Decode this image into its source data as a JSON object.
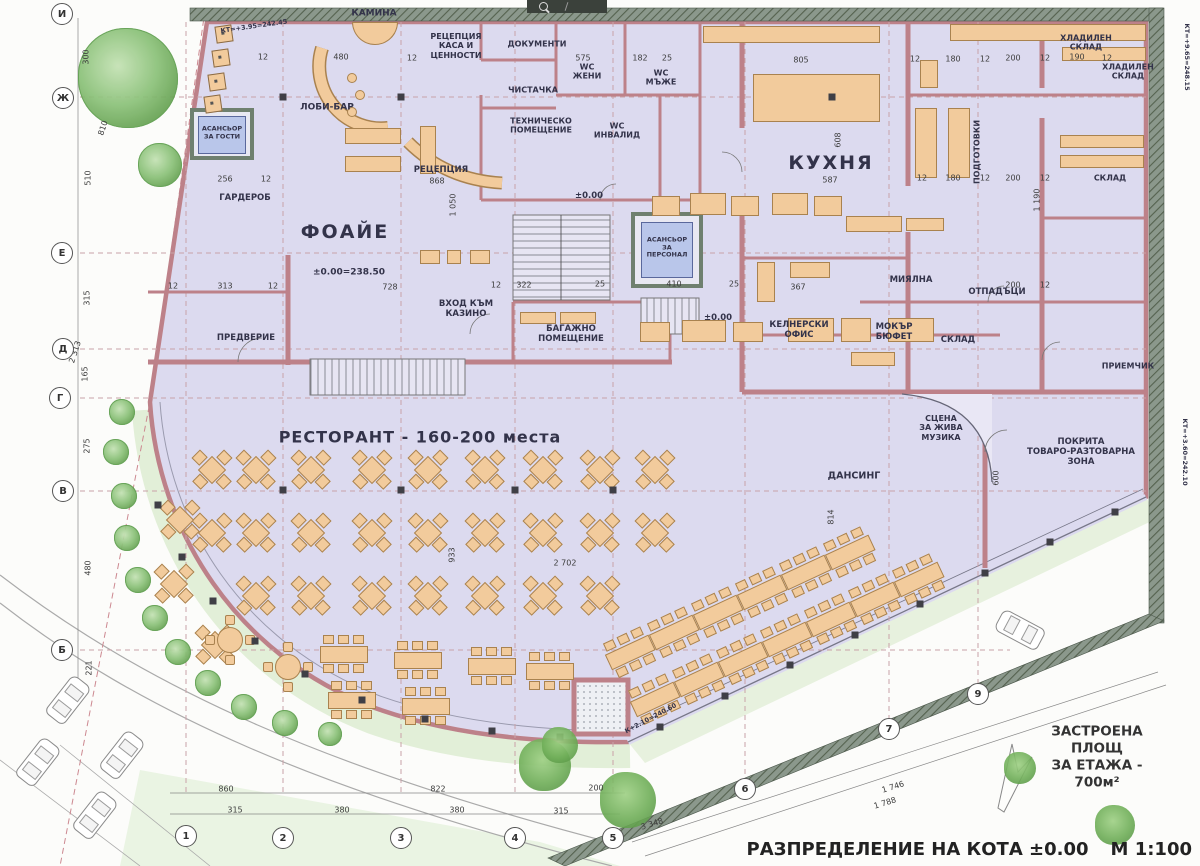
{
  "title_block": {
    "title": "РАЗПРЕДЕЛЕНИЕ НА КОТА ±0.00",
    "scale": "М 1:100",
    "area_note": "ЗАСТРОЕНА ПЛОЩ\nЗА ЕТАЖА - 700м²"
  },
  "labels": [
    {
      "n": "fireplace",
      "t": "КАМИНА",
      "x": 374,
      "y": 14,
      "fs": 9
    },
    {
      "n": "reception-cash",
      "t": "РЕЦЕПЦИЯ\nКАСА И\nЦЕННОСТИ",
      "x": 456,
      "y": 46,
      "fs": 8
    },
    {
      "n": "documents",
      "t": "ДОКУМЕНТИ",
      "x": 537,
      "y": 44,
      "fs": 8
    },
    {
      "n": "cleaner",
      "t": "ЧИСТАЧКА",
      "x": 533,
      "y": 90,
      "fs": 8
    },
    {
      "n": "tech-room",
      "t": "ТЕХНИЧЕСКО\nПОМЕЩЕНИЕ",
      "x": 541,
      "y": 126,
      "fs": 8
    },
    {
      "n": "lobby-bar",
      "t": "ЛОБИ-БАР",
      "x": 327,
      "y": 108,
      "fs": 9
    },
    {
      "n": "reception",
      "t": "РЕЦЕПЦИЯ",
      "x": 441,
      "y": 170,
      "fs": 8.5
    },
    {
      "n": "guest-elevator",
      "t": "АСАНСЬОР\nЗА ГОСТИ",
      "x": 222,
      "y": 133,
      "fs": 6.5
    },
    {
      "n": "wardrobe",
      "t": "ГАРДЕРОБ",
      "x": 245,
      "y": 198,
      "fs": 8.5
    },
    {
      "n": "foyer",
      "t": "ФОАЙЕ",
      "x": 345,
      "y": 232,
      "fs": 19,
      "ls": 2
    },
    {
      "n": "foyer-level",
      "t": "±0.00=238.50",
      "x": 349,
      "y": 273,
      "fs": 9
    },
    {
      "n": "vestibule",
      "t": "ПРЕДВЕРИЕ",
      "x": 246,
      "y": 338,
      "fs": 8.5
    },
    {
      "n": "casino-entrance",
      "t": "ВХОД КЪМ\nКАЗИНО",
      "x": 466,
      "y": 309,
      "fs": 8.5
    },
    {
      "n": "luggage-room",
      "t": "БАГАЖНО\nПОМЕЩЕНИЕ",
      "x": 571,
      "y": 334,
      "fs": 8.5
    },
    {
      "n": "staff-elevator",
      "t": "АСАНСЬОР\nЗА\nПЕРСОНАЛ",
      "x": 667,
      "y": 248,
      "fs": 6.5
    },
    {
      "n": "wc-women",
      "t": "WC\nЖЕНИ",
      "x": 587,
      "y": 72,
      "fs": 8
    },
    {
      "n": "wc-men",
      "t": "WC\nМЪЖЕ",
      "x": 661,
      "y": 78,
      "fs": 8
    },
    {
      "n": "wc-disabled",
      "t": "WC\nИНВАЛИД",
      "x": 617,
      "y": 131,
      "fs": 8
    },
    {
      "n": "kitchen",
      "t": "КУХНЯ",
      "x": 831,
      "y": 163,
      "fs": 19,
      "ls": 2
    },
    {
      "n": "prep",
      "t": "ПОДГОТОВКИ",
      "x": 977,
      "y": 152,
      "fs": 8,
      "r": -90
    },
    {
      "n": "cold-store-1",
      "t": "ХЛАДИЛЕН\nСКЛАД",
      "x": 1086,
      "y": 43,
      "fs": 8
    },
    {
      "n": "cold-store-2",
      "t": "ХЛАДИЛЕН\nСКЛАД",
      "x": 1128,
      "y": 72,
      "fs": 8
    },
    {
      "n": "store-right",
      "t": "СКЛАД",
      "x": 1110,
      "y": 178,
      "fs": 8
    },
    {
      "n": "dishwashing",
      "t": "МИЯЛНА",
      "x": 911,
      "y": 280,
      "fs": 8.5
    },
    {
      "n": "waste",
      "t": "ОТПАДЪЦИ",
      "x": 997,
      "y": 292,
      "fs": 8.5
    },
    {
      "n": "waiter-office",
      "t": "КЕЛНЕРСКИ\nОФИС",
      "x": 799,
      "y": 330,
      "fs": 8.5
    },
    {
      "n": "wet-buffet",
      "t": "МОКЪР\nБЮФЕТ",
      "x": 894,
      "y": 332,
      "fs": 8.5
    },
    {
      "n": "store-mid",
      "t": "СКЛАД",
      "x": 958,
      "y": 340,
      "fs": 8.5
    },
    {
      "n": "receiving",
      "t": "ПРИЕМЧИК",
      "x": 1128,
      "y": 366,
      "fs": 8
    },
    {
      "n": "restaurant",
      "t": "РЕСТОРАНТ  -  160-200 места",
      "x": 420,
      "y": 438,
      "fs": 16,
      "ls": 1
    },
    {
      "n": "stage",
      "t": "СЦЕНА\nЗА ЖИВА\nМУЗИКА",
      "x": 941,
      "y": 428,
      "fs": 8
    },
    {
      "n": "dance-floor",
      "t": "ДАНСИНГ",
      "x": 854,
      "y": 476,
      "fs": 9.5
    },
    {
      "n": "loading-zone",
      "t": "ПОКРИТА\nТОВАРО-РАЗТОВАРНА\nЗОНА",
      "x": 1081,
      "y": 452,
      "fs": 8.5
    },
    {
      "n": "level-main",
      "t": "±0.00",
      "x": 589,
      "y": 196,
      "fs": 8.5
    },
    {
      "n": "level-foyer",
      "t": "±0.00",
      "x": 718,
      "y": 318,
      "fs": 8.5
    },
    {
      "n": "kt-top-left",
      "t": "КТ=+3.95=242.45",
      "x": 254,
      "y": 27,
      "fs": 6.5,
      "r": -8
    },
    {
      "n": "kt-right-top",
      "t": "КТ=+9.65=248.15",
      "x": 1186,
      "y": 57,
      "fs": 6.5,
      "r": 90
    },
    {
      "n": "kt-right-low",
      "t": "КТ=+3.60=242.10",
      "x": 1184,
      "y": 452,
      "fs": 6.5,
      "r": 90
    },
    {
      "n": "k-terrace",
      "t": "К+2.10=240.60",
      "x": 651,
      "y": 719,
      "fs": 6.5,
      "r": -28
    }
  ],
  "dims": [
    {
      "t": "300",
      "x": 86,
      "y": 57,
      "r": -90
    },
    {
      "t": "810",
      "x": 103,
      "y": 128,
      "r": -72
    },
    {
      "t": "510",
      "x": 88,
      "y": 178,
      "r": -90
    },
    {
      "t": "315",
      "x": 87,
      "y": 298,
      "r": -90
    },
    {
      "t": "165",
      "x": 85,
      "y": 374,
      "r": -90
    },
    {
      "t": "275",
      "x": 87,
      "y": 446,
      "r": -90
    },
    {
      "t": "480",
      "x": 88,
      "y": 568,
      "r": -90
    },
    {
      "t": "221",
      "x": 89,
      "y": 668,
      "r": -90
    },
    {
      "t": "2 313",
      "x": 75,
      "y": 352,
      "r": -72
    },
    {
      "t": "12",
      "x": 263,
      "y": 57
    },
    {
      "t": "480",
      "x": 341,
      "y": 57
    },
    {
      "t": "12",
      "x": 412,
      "y": 58
    },
    {
      "t": "575",
      "x": 583,
      "y": 58
    },
    {
      "t": "182",
      "x": 640,
      "y": 58
    },
    {
      "t": "25",
      "x": 667,
      "y": 58
    },
    {
      "t": "805",
      "x": 801,
      "y": 60
    },
    {
      "t": "12",
      "x": 915,
      "y": 59
    },
    {
      "t": "180",
      "x": 953,
      "y": 59
    },
    {
      "t": "12",
      "x": 985,
      "y": 59
    },
    {
      "t": "200",
      "x": 1013,
      "y": 58
    },
    {
      "t": "12",
      "x": 1045,
      "y": 58
    },
    {
      "t": "190",
      "x": 1077,
      "y": 57
    },
    {
      "t": "12",
      "x": 1107,
      "y": 58
    },
    {
      "t": "868",
      "x": 437,
      "y": 181
    },
    {
      "t": "256",
      "x": 225,
      "y": 179
    },
    {
      "t": "12",
      "x": 266,
      "y": 179
    },
    {
      "t": "1 050",
      "x": 453,
      "y": 205,
      "r": -90
    },
    {
      "t": "608",
      "x": 838,
      "y": 140,
      "r": -90
    },
    {
      "t": "587",
      "x": 830,
      "y": 180
    },
    {
      "t": "12",
      "x": 173,
      "y": 286
    },
    {
      "t": "313",
      "x": 225,
      "y": 286
    },
    {
      "t": "12",
      "x": 273,
      "y": 286
    },
    {
      "t": "728",
      "x": 390,
      "y": 287
    },
    {
      "t": "12",
      "x": 496,
      "y": 285
    },
    {
      "t": "322",
      "x": 524,
      "y": 285
    },
    {
      "t": "25",
      "x": 600,
      "y": 284
    },
    {
      "t": "410",
      "x": 674,
      "y": 284
    },
    {
      "t": "25",
      "x": 734,
      "y": 284
    },
    {
      "t": "367",
      "x": 798,
      "y": 287
    },
    {
      "t": "12",
      "x": 922,
      "y": 178
    },
    {
      "t": "180",
      "x": 953,
      "y": 178
    },
    {
      "t": "12",
      "x": 985,
      "y": 178
    },
    {
      "t": "200",
      "x": 1013,
      "y": 178
    },
    {
      "t": "12",
      "x": 1045,
      "y": 178
    },
    {
      "t": "1 190",
      "x": 1037,
      "y": 200,
      "r": -90
    },
    {
      "t": "200",
      "x": 1013,
      "y": 285
    },
    {
      "t": "12",
      "x": 1045,
      "y": 285
    },
    {
      "t": "933",
      "x": 452,
      "y": 555,
      "r": -90
    },
    {
      "t": "2 702",
      "x": 565,
      "y": 563
    },
    {
      "t": "814",
      "x": 831,
      "y": 517,
      "r": -90
    },
    {
      "t": "600",
      "x": 996,
      "y": 478,
      "r": -90
    },
    {
      "t": "860",
      "x": 226,
      "y": 789
    },
    {
      "t": "822",
      "x": 438,
      "y": 789
    },
    {
      "t": "200",
      "x": 596,
      "y": 788
    },
    {
      "t": "315",
      "x": 235,
      "y": 810
    },
    {
      "t": "380",
      "x": 342,
      "y": 810
    },
    {
      "t": "380",
      "x": 457,
      "y": 810
    },
    {
      "t": "315",
      "x": 561,
      "y": 811
    },
    {
      "t": "3 348",
      "x": 652,
      "y": 824,
      "r": -17
    },
    {
      "t": "1 746",
      "x": 893,
      "y": 787,
      "r": -17
    },
    {
      "t": "1 788",
      "x": 885,
      "y": 803,
      "r": -17
    }
  ],
  "grid": {
    "rows": [
      {
        "t": "И",
        "x": 62,
        "y": 14
      },
      {
        "t": "Ж",
        "x": 63,
        "y": 98
      },
      {
        "t": "Е",
        "x": 62,
        "y": 253
      },
      {
        "t": "Д",
        "x": 63,
        "y": 349
      },
      {
        "t": "Г",
        "x": 60,
        "y": 398
      },
      {
        "t": "В",
        "x": 63,
        "y": 491
      },
      {
        "t": "Б",
        "x": 62,
        "y": 650
      }
    ],
    "cols": [
      {
        "t": "1",
        "x": 186,
        "y": 836
      },
      {
        "t": "2",
        "x": 283,
        "y": 838
      },
      {
        "t": "3",
        "x": 401,
        "y": 838
      },
      {
        "t": "4",
        "x": 515,
        "y": 838
      },
      {
        "t": "5",
        "x": 613,
        "y": 838
      },
      {
        "t": "6",
        "x": 745,
        "y": 789
      },
      {
        "t": "7",
        "x": 889,
        "y": 729
      },
      {
        "t": "9",
        "x": 978,
        "y": 694
      }
    ]
  },
  "furniture": {
    "diamond_tables": [
      [
        212,
        470
      ],
      [
        256,
        470
      ],
      [
        311,
        470
      ],
      [
        372,
        470
      ],
      [
        428,
        470
      ],
      [
        485,
        470
      ],
      [
        543,
        470
      ],
      [
        600,
        470
      ],
      [
        655,
        470
      ],
      [
        212,
        533
      ],
      [
        256,
        533
      ],
      [
        311,
        533
      ],
      [
        372,
        533
      ],
      [
        428,
        533
      ],
      [
        485,
        533
      ],
      [
        543,
        533
      ],
      [
        600,
        533
      ],
      [
        655,
        533
      ],
      [
        256,
        596
      ],
      [
        311,
        596
      ],
      [
        372,
        596
      ],
      [
        428,
        596
      ],
      [
        485,
        596
      ],
      [
        543,
        596
      ],
      [
        600,
        596
      ],
      [
        180,
        520
      ],
      [
        174,
        584
      ],
      [
        215,
        645
      ]
    ],
    "rect_tables": [
      [
        630,
        652
      ],
      [
        674,
        632
      ],
      [
        718,
        612
      ],
      [
        762,
        592
      ],
      [
        806,
        572
      ],
      [
        850,
        552
      ],
      [
        655,
        699
      ],
      [
        699,
        679
      ],
      [
        743,
        659
      ],
      [
        787,
        639
      ],
      [
        831,
        619
      ],
      [
        875,
        599
      ],
      [
        919,
        579
      ]
    ],
    "long_tables": [
      [
        344,
        654
      ],
      [
        418,
        660
      ],
      [
        492,
        666
      ],
      [
        550,
        671
      ],
      [
        352,
        700
      ],
      [
        426,
        706
      ]
    ],
    "round_tables": [
      [
        230,
        640
      ],
      [
        288,
        667
      ]
    ],
    "tan_rects": [
      [
        345,
        128,
        56,
        16
      ],
      [
        345,
        156,
        56,
        16
      ],
      [
        420,
        126,
        16,
        48
      ],
      [
        652,
        196,
        28,
        20
      ],
      [
        690,
        193,
        36,
        22
      ],
      [
        731,
        196,
        28,
        20
      ],
      [
        772,
        193,
        36,
        22
      ],
      [
        814,
        196,
        28,
        20
      ],
      [
        640,
        322,
        30,
        20
      ],
      [
        682,
        320,
        44,
        22
      ],
      [
        733,
        322,
        30,
        20
      ],
      [
        788,
        318,
        46,
        24
      ],
      [
        841,
        318,
        30,
        24
      ],
      [
        888,
        318,
        46,
        24
      ],
      [
        420,
        250,
        20,
        14
      ],
      [
        447,
        250,
        14,
        14
      ],
      [
        470,
        250,
        20,
        14
      ],
      [
        703,
        26,
        177,
        17
      ],
      [
        753,
        74,
        127,
        48
      ],
      [
        950,
        24,
        196,
        17
      ],
      [
        1062,
        47,
        84,
        14
      ],
      [
        915,
        108,
        22,
        70
      ],
      [
        948,
        108,
        22,
        70
      ],
      [
        1060,
        135,
        84,
        13
      ],
      [
        1060,
        155,
        84,
        13
      ],
      [
        846,
        216,
        56,
        16
      ],
      [
        906,
        218,
        38,
        13
      ],
      [
        757,
        262,
        18,
        40
      ],
      [
        790,
        262,
        40,
        16
      ],
      [
        851,
        352,
        44,
        14
      ],
      [
        920,
        60,
        18,
        28
      ],
      [
        520,
        312,
        36,
        12
      ],
      [
        560,
        312,
        36,
        12
      ]
    ],
    "posts": [
      [
        660,
        727
      ],
      [
        725,
        696
      ],
      [
        790,
        665
      ],
      [
        855,
        635
      ],
      [
        920,
        604
      ],
      [
        985,
        573
      ],
      [
        1050,
        542
      ],
      [
        1115,
        512
      ],
      [
        560,
        737
      ],
      [
        492,
        731
      ],
      [
        425,
        719
      ],
      [
        362,
        700
      ],
      [
        305,
        674
      ],
      [
        255,
        641
      ],
      [
        213,
        601
      ],
      [
        182,
        557
      ],
      [
        158,
        505
      ],
      [
        283,
        97
      ],
      [
        401,
        97
      ],
      [
        832,
        97
      ],
      [
        283,
        490
      ],
      [
        401,
        490
      ],
      [
        515,
        490
      ],
      [
        613,
        490
      ]
    ],
    "planters": [
      [
        224,
        34
      ],
      [
        221,
        58
      ],
      [
        217,
        82
      ],
      [
        213,
        104
      ]
    ],
    "stools": [
      [
        352,
        78
      ],
      [
        360,
        95
      ],
      [
        352,
        112
      ]
    ]
  },
  "site": {
    "trees": [
      [
        128,
        78,
        50
      ],
      [
        160,
        165,
        22
      ],
      [
        122,
        412,
        13
      ],
      [
        116,
        452,
        13
      ],
      [
        124,
        496,
        13
      ],
      [
        127,
        538,
        13
      ],
      [
        138,
        580,
        13
      ],
      [
        155,
        618,
        13
      ],
      [
        178,
        652,
        13
      ],
      [
        208,
        683,
        13
      ],
      [
        244,
        707,
        13
      ],
      [
        285,
        723,
        13
      ],
      [
        330,
        734,
        12
      ]
    ],
    "bushes": [
      [
        545,
        765,
        26
      ],
      [
        628,
        800,
        28
      ],
      [
        1020,
        768,
        16
      ],
      [
        1115,
        825,
        20
      ],
      [
        560,
        745,
        18
      ]
    ],
    "cars": [
      [
        68,
        700,
        38
      ],
      [
        122,
        755,
        38
      ],
      [
        38,
        762,
        38
      ],
      [
        95,
        815,
        38
      ],
      [
        1020,
        630,
        -62
      ]
    ]
  },
  "colors": {
    "floor": "#dcdaef",
    "wall": "#bd8189",
    "site_wall": "#8b988c",
    "furniture": "#f2cb9c",
    "furniture_border": "#a9824f",
    "elevator_cab": "#b9c6ea",
    "grid_line": "#c9a2a8",
    "green_dark": "#5e9e4e",
    "green_light": "#a8d196"
  }
}
